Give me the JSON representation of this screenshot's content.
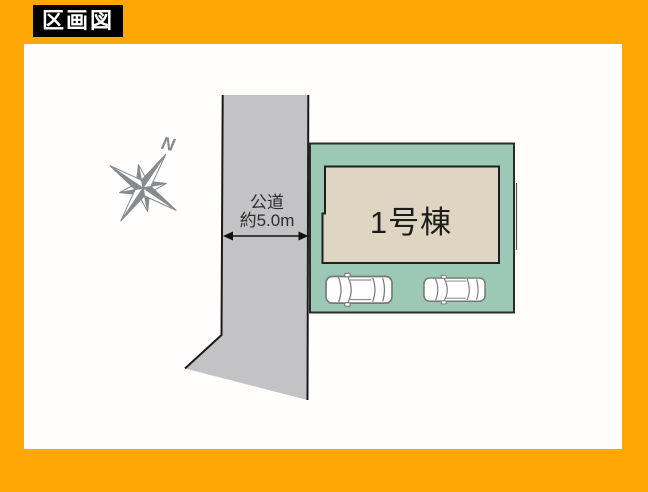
{
  "header": {
    "title": "区画図"
  },
  "plan": {
    "road": {
      "label_line1": "公道",
      "label_line2": "約5.0m"
    },
    "building": {
      "label": "1号棟"
    },
    "compass": {
      "north_label": "N"
    },
    "parking": {
      "car_icons": 2
    },
    "colors": {
      "frame_orange": "#ffa705",
      "road_gray": "#c3c3c5",
      "plot_teal": "#9cc8b6",
      "building_beige": "#ded6c3",
      "outline_dark": "#1a1a1a",
      "compass_gray": "#868b90"
    }
  }
}
